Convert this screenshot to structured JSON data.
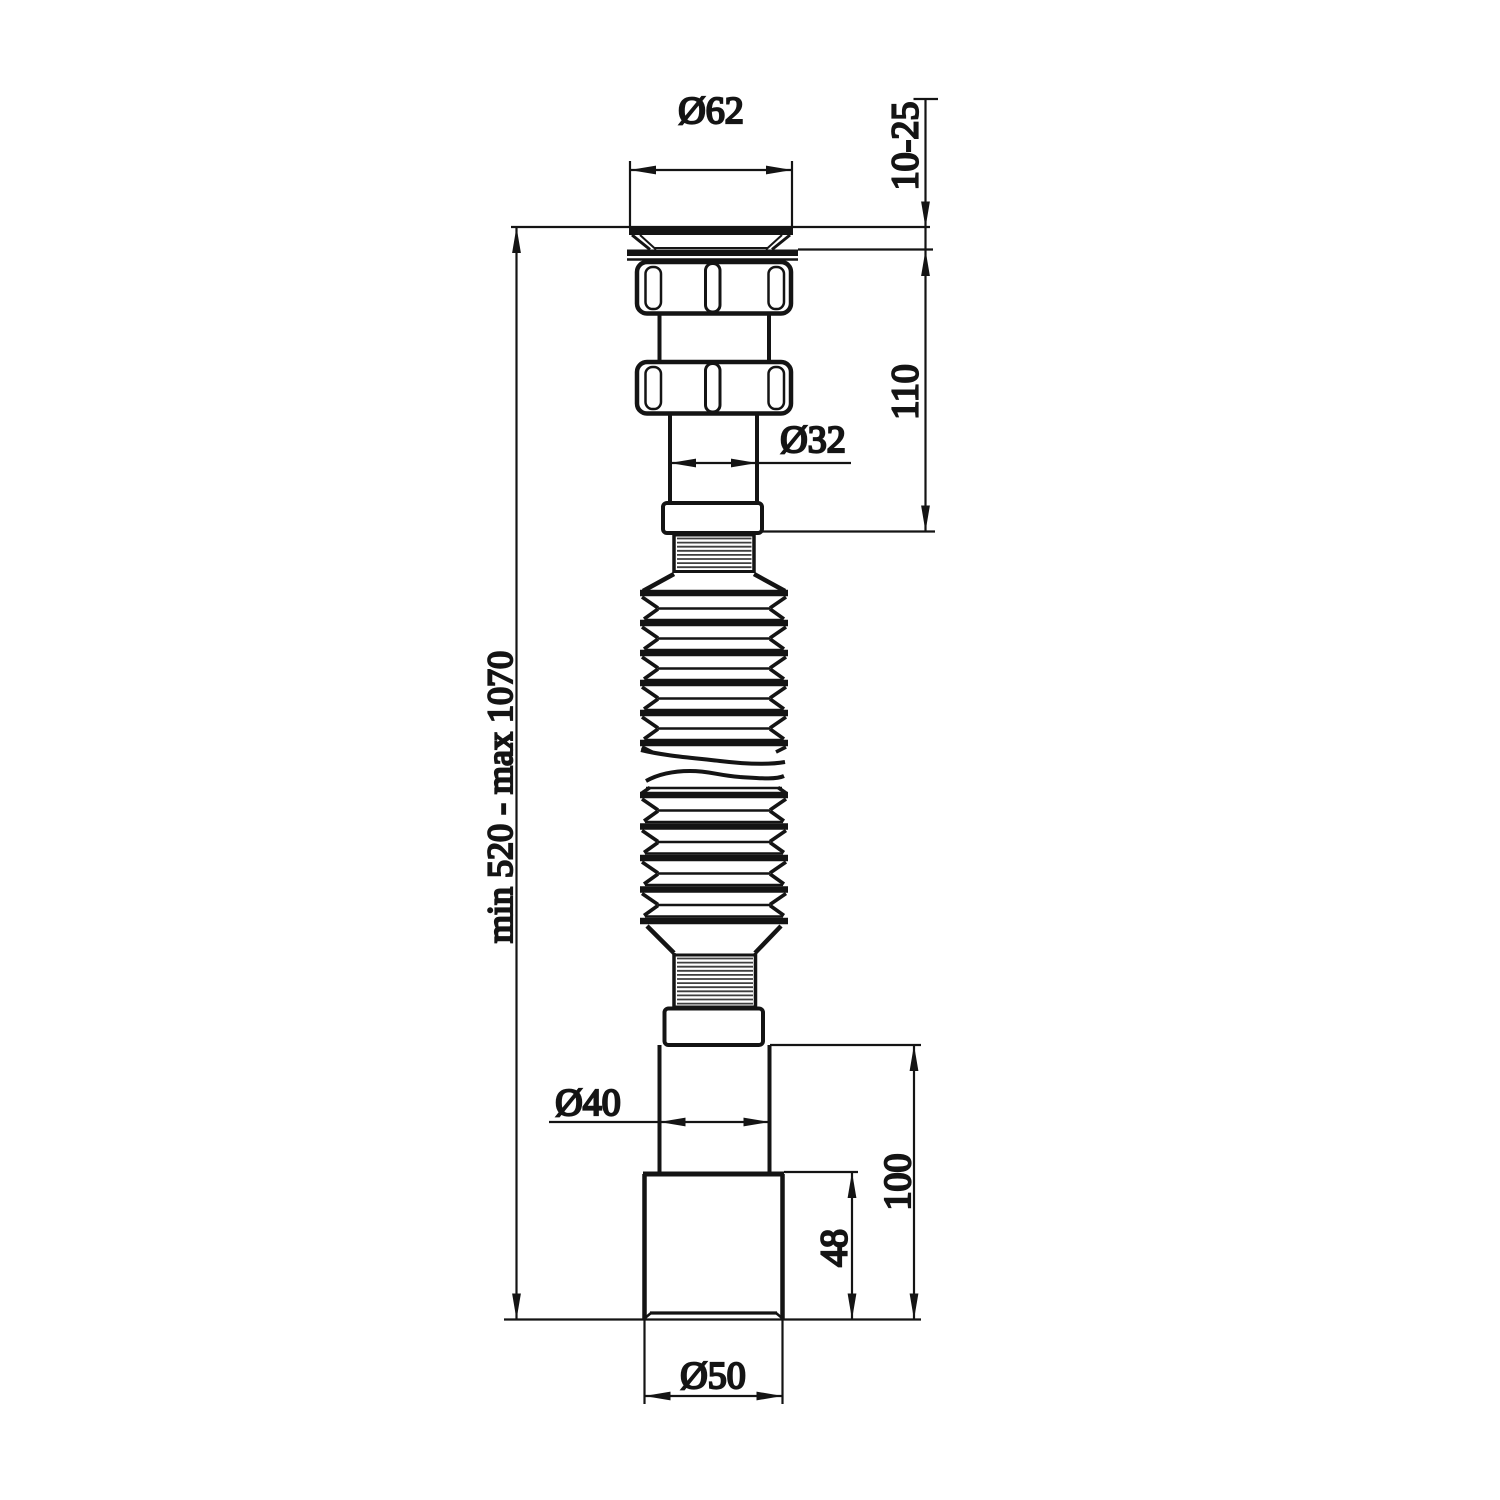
{
  "drawing": {
    "background": "#ffffff",
    "line_color": "#141414",
    "hatch_color": "#3f3f3f",
    "dimensions": {
      "flange_diameter": "Ø62",
      "installation_thickness": "10-25",
      "inlet_section_height": "110",
      "inlet_pipe_diameter": "Ø32",
      "overall_length": "min 520 - max 1070",
      "outlet_pipe_diameter": "Ø40",
      "outlet_section_height": "100",
      "outlet_cup_height": "48",
      "outlet_cup_diameter": "Ø50"
    }
  }
}
